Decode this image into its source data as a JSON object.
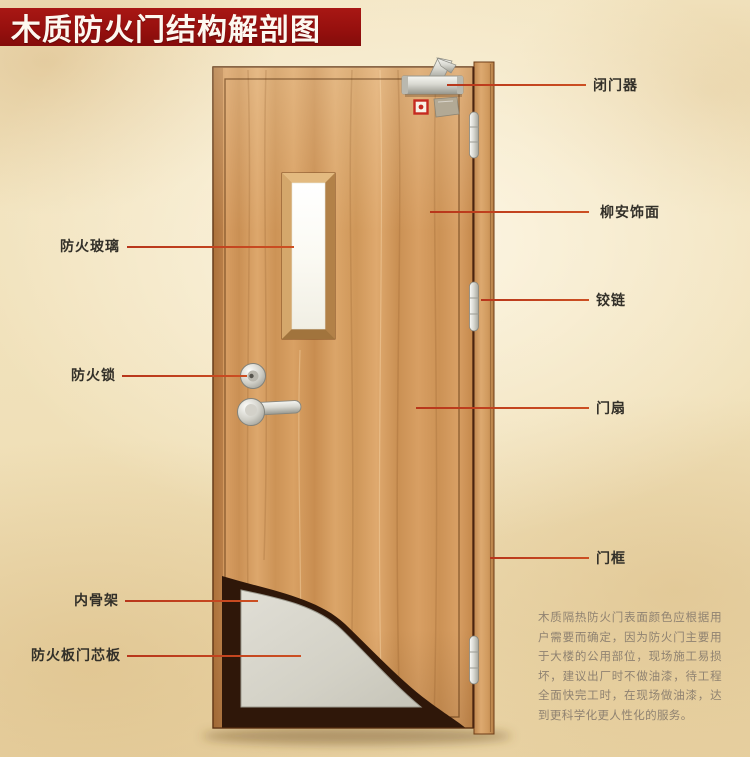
{
  "banner": {
    "title": "木质防火门结构解剖图"
  },
  "callouts": {
    "right": [
      {
        "id": "door-closer",
        "label": "闭门器"
      },
      {
        "id": "lauan-veneer",
        "label": "柳安饰面"
      },
      {
        "id": "hinge",
        "label": "铰链"
      },
      {
        "id": "door-leaf",
        "label": "门扇"
      },
      {
        "id": "door-frame",
        "label": "门框"
      }
    ],
    "left": [
      {
        "id": "fire-glass",
        "label": "防火玻璃"
      },
      {
        "id": "fire-lock",
        "label": "防火锁"
      },
      {
        "id": "inner-skeleton",
        "label": "内骨架"
      },
      {
        "id": "fire-board-core",
        "label": "防火板门芯板"
      }
    ]
  },
  "description": {
    "text": "木质隔热防火门表面颜色应根据用户需要而确定，因为防火门主要用于大楼的公用部位，现场施工易损坏，建议出厂时不做油漆，待工程全面快完工时，在现场做油漆，达到更科学化更人性化的服务。"
  },
  "colors": {
    "banner_red": "#97100e",
    "leader_line": "#c4411f",
    "label_text": "#333029",
    "description_text": "#8f8271",
    "door_wood": "#d09a60",
    "core_panel_gray": "#d5d3c9",
    "skeleton_dark": "#2f1709"
  }
}
